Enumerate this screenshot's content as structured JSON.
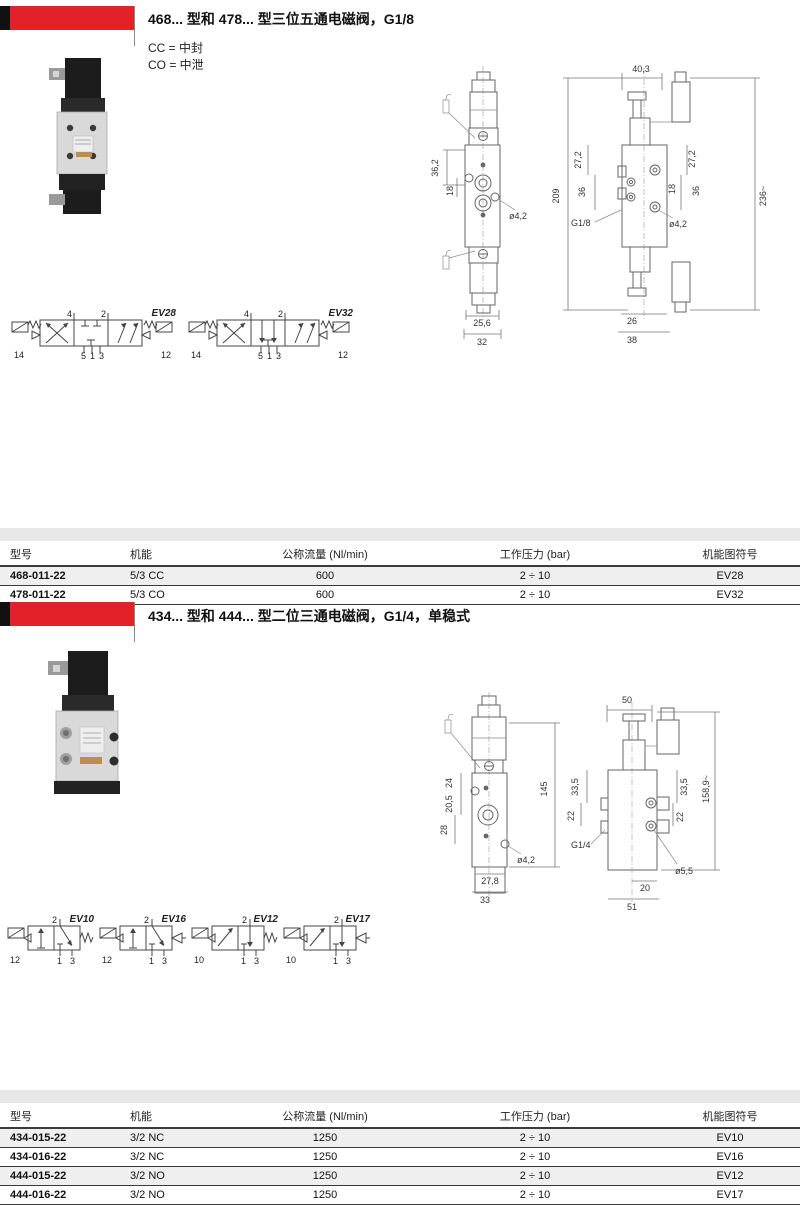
{
  "page": {
    "accent_red": "#e32128",
    "band_gray": "#e8e8e8",
    "row_shade": "#efefef"
  },
  "s1": {
    "title": "468... 型和 478... 型三位五通电磁阀，G1/8",
    "legend_cc": "CC = 中封",
    "legend_co": "CO = 中泄",
    "front": {
      "d1": "36,2",
      "d2": "18",
      "hole": "ø4,2",
      "w_inner": "25,6",
      "w_outer": "32"
    },
    "side": {
      "w_top": "40,3",
      "h_left": "209",
      "l1": "27,2",
      "l2": "36",
      "r1": "27,2",
      "r2": "36",
      "r3": "18",
      "h_total": "236~",
      "hole": "ø4,2",
      "thread": "G1/8",
      "w_inner": "26",
      "w_outer": "38"
    },
    "sym": [
      {
        "label": "EV28",
        "t1": "4",
        "t2": "2",
        "b1": "14",
        "b2": "5",
        "b3": "1",
        "b4": "3",
        "b5": "12"
      },
      {
        "label": "EV32",
        "t1": "4",
        "t2": "2",
        "b1": "14",
        "b2": "5",
        "b3": "1",
        "b4": "3",
        "b5": "12"
      }
    ],
    "table": {
      "headers": [
        "型号",
        "机能",
        "公称流量 (Nl/min)",
        "工作压力 (bar)",
        "机能图符号"
      ],
      "rows": [
        [
          "468-011-22",
          "5/3 CC",
          "600",
          "2 ÷ 10",
          "EV28"
        ],
        [
          "478-011-22",
          "5/3 CO",
          "600",
          "2 ÷ 10",
          "EV32"
        ]
      ]
    }
  },
  "s2": {
    "title": "434... 型和 444... 型二位三通电磁阀，G1/4，单稳式",
    "front": {
      "d1": "24",
      "d2": "20,5",
      "d3": "28",
      "hole": "ø4,2",
      "w_inner": "27,8",
      "w_outer": "33",
      "h_left": "145"
    },
    "side": {
      "w_top": "50",
      "h_total": "158,9~",
      "l1": "33,5",
      "l2": "22",
      "r1": "33,5",
      "r2": "22",
      "thread": "G1/4",
      "hole": "ø5,5",
      "w_inner": "20",
      "w_outer": "51"
    },
    "sym": [
      {
        "label": "EV10",
        "pilot": "12",
        "t": "2",
        "b1": "1",
        "b2": "3"
      },
      {
        "label": "EV16",
        "pilot": "12",
        "t": "2",
        "b1": "1",
        "b2": "3"
      },
      {
        "label": "EV12",
        "pilot": "10",
        "t": "2",
        "b1": "1",
        "b2": "3"
      },
      {
        "label": "EV17",
        "pilot": "10",
        "t": "2",
        "b1": "1",
        "b2": "3"
      }
    ],
    "table": {
      "headers": [
        "型号",
        "机能",
        "公称流量 (Nl/min)",
        "工作压力 (bar)",
        "机能图符号"
      ],
      "rows": [
        [
          "434-015-22",
          "3/2 NC",
          "1250",
          "2 ÷ 10",
          "EV10"
        ],
        [
          "434-016-22",
          "3/2 NC",
          "1250",
          "2 ÷ 10",
          "EV16"
        ],
        [
          "444-015-22",
          "3/2 NO",
          "1250",
          "2 ÷ 10",
          "EV12"
        ],
        [
          "444-016-22",
          "3/2 NO",
          "1250",
          "2 ÷ 10",
          "EV17"
        ]
      ]
    }
  }
}
